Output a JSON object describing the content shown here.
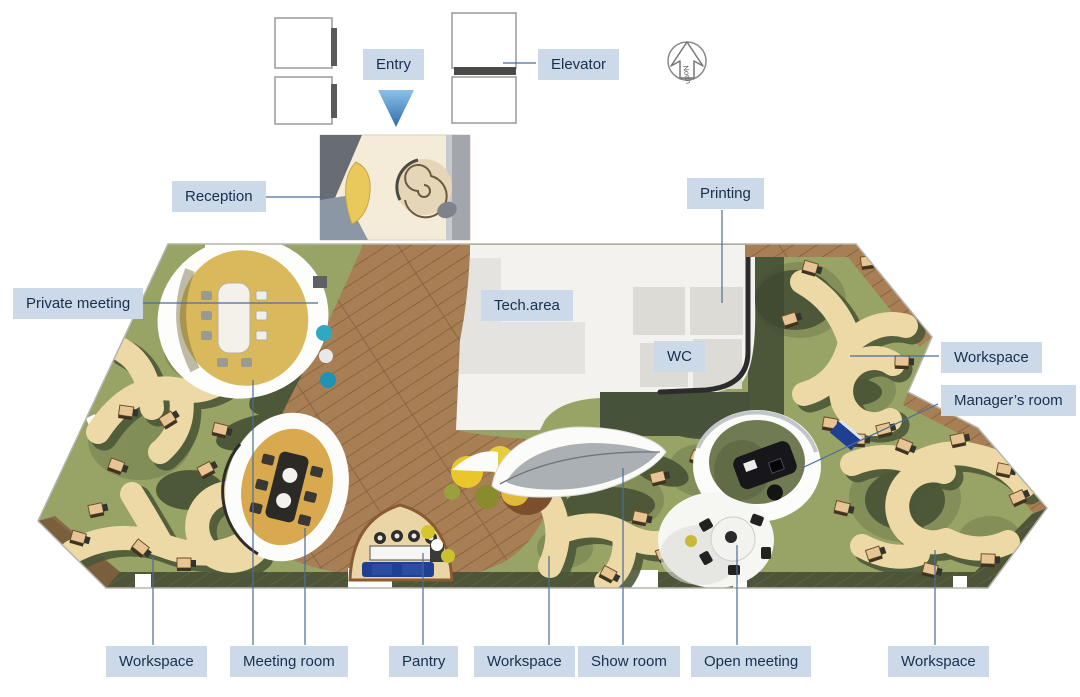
{
  "labels": {
    "entry": "Entry",
    "elevator": "Elevator",
    "reception": "Reception",
    "private_meeting": "Private meeting",
    "tech_area": "Tech.area",
    "wc": "WC",
    "printing": "Printing",
    "workspace_right": "Workspace",
    "managers_room": "Manager’s room",
    "workspace_bottom_left": "Workspace",
    "meeting_room": "Meeting room",
    "pantry": "Pantry",
    "workspace_bottom_center": "Workspace",
    "show_room": "Show room",
    "open_meeting": "Open meeting",
    "workspace_bottom_right": "Workspace",
    "north": "North"
  },
  "icons": {
    "north_arrow_icon": "↑",
    "entry_arrow_icon": "▼"
  },
  "colors": {
    "label_bg": "#cbd9e9",
    "label_text": "#17304d",
    "leader_line": "#4a6e96",
    "wood": "#a87f55",
    "wood_line": "#8a6542",
    "carpet_green": "#98a366",
    "carpet_shadow": "#4d5838",
    "desk_tan": "#ecd9a6",
    "room_yellow": "#d9b95c",
    "room_orange": "#d8a94e",
    "leaf_gray": "#abb0b5",
    "couch_navy": "#1e3f92",
    "bean_bag_yellow": "#e8c62c",
    "entry_arrow_blue": "#4f87c0",
    "wall_dark": "#2c2c2e"
  }
}
